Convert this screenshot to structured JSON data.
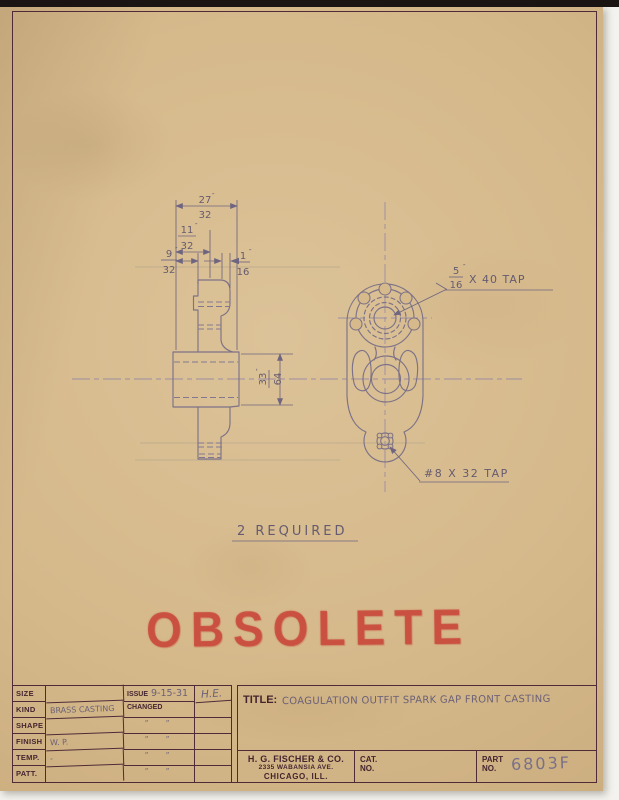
{
  "colors": {
    "paper": "#d5b98b",
    "frame_ink": "#4e2b37",
    "pencil": "#7d7287",
    "stamp_red": "#c9463a"
  },
  "drawing": {
    "dims": {
      "w2732": {
        "num": "27",
        "den": "32",
        "unit": "″"
      },
      "w1132": {
        "num": "11",
        "den": "32",
        "unit": "″"
      },
      "w932": {
        "num": "9",
        "den": "32",
        "unit": "″"
      },
      "w116": {
        "num": "1",
        "den": "16",
        "unit": "″"
      },
      "h3364": {
        "num": "33",
        "den": "64",
        "unit": "″"
      }
    },
    "callouts": {
      "tap_top": {
        "num": "5",
        "den": "16",
        "unit": "″",
        "rest": "X 40 TAP"
      },
      "tap_bottom": "#8 X 32 TAP"
    },
    "note": "2 REQUIRED"
  },
  "stamp": "OBSOLETE",
  "title_block": {
    "rows": [
      {
        "label": "SIZE",
        "value": ""
      },
      {
        "label": "KIND",
        "value": "BRASS CASTING"
      },
      {
        "label": "SHAPE",
        "value": ""
      },
      {
        "label": "FINISH",
        "value": "W. P."
      },
      {
        "label": "TEMP.",
        "value": "-"
      },
      {
        "label": "PATT.",
        "value": ""
      }
    ],
    "issue_label": "ISSUE",
    "issue_date": "9-15-31",
    "initials": "H.E.",
    "changed_label": "CHANGED",
    "ditto_mark": "″",
    "title_label": "TITLE:",
    "title_text": "COAGULATION OUTFIT SPARK GAP FRONT CASTING",
    "company": {
      "name": "H. G. FISCHER & CO.",
      "address": "2335 WABANSIA AVE.",
      "city": "CHICAGO, ILL."
    },
    "cat_label": "CAT.",
    "cat_no_label": "NO.",
    "cat_value": "",
    "part_label": "PART",
    "part_no_label": "NO.",
    "part_number": "6803F"
  }
}
